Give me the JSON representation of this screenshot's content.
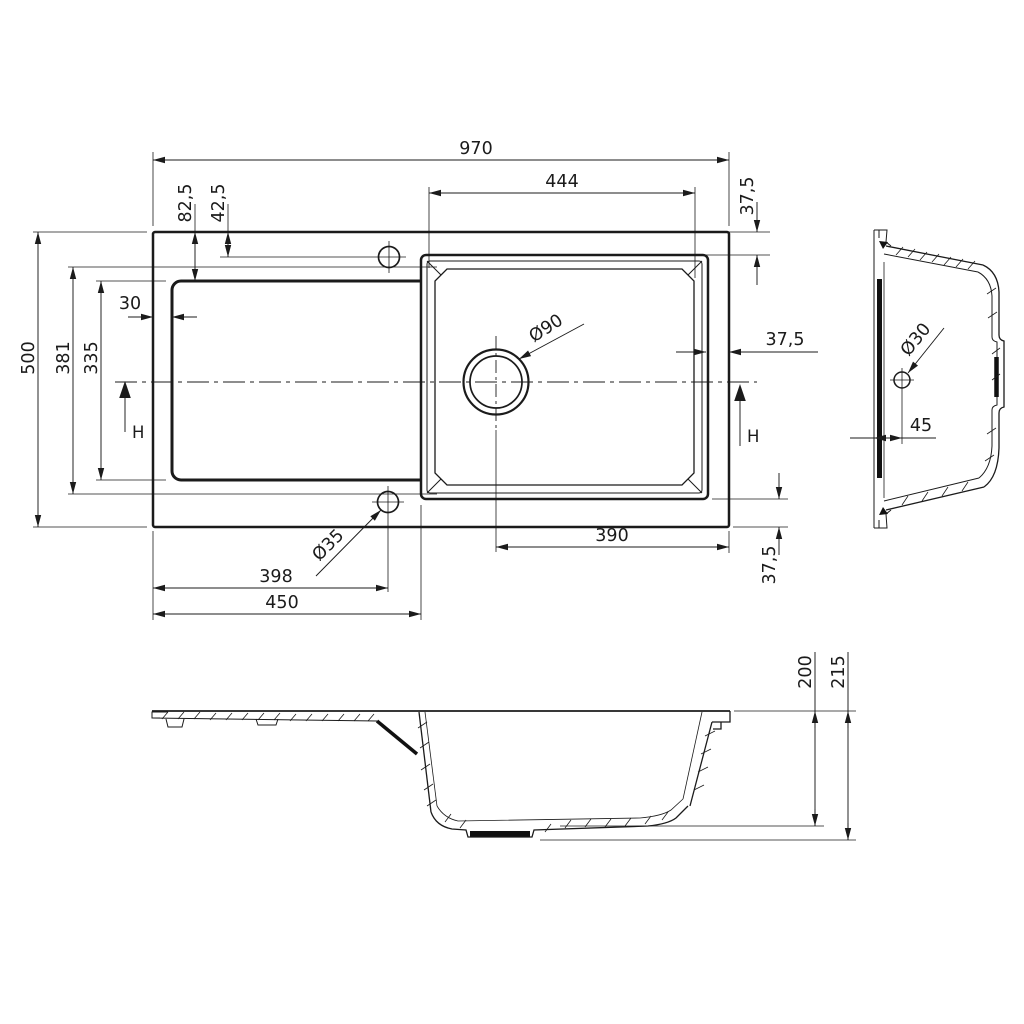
{
  "top_view": {
    "overall_width": "970",
    "bowl_width": "444",
    "rim_margin_top": "37,5",
    "tap_hole_offset_a": "82,5",
    "tap_hole_offset_b": "42,5",
    "overall_depth": "500",
    "inner_depth": "381",
    "drainer_depth": "335",
    "drainer_margin_left": "30",
    "drain_diameter": "Ø90",
    "rim_margin_right": "37,5",
    "height_marker_left": "H",
    "height_marker_right": "H",
    "drain_to_edge": "390",
    "rim_margin_bottom": "37,5",
    "outlet_hole_diameter": "Ø35",
    "outlet_hole_offset": "398",
    "drainer_width": "450"
  },
  "side_view": {
    "hole_diameter": "Ø30",
    "hole_offset_from_face": "45"
  },
  "section_view": {
    "bowl_depth": "200",
    "overall_height": "215"
  }
}
